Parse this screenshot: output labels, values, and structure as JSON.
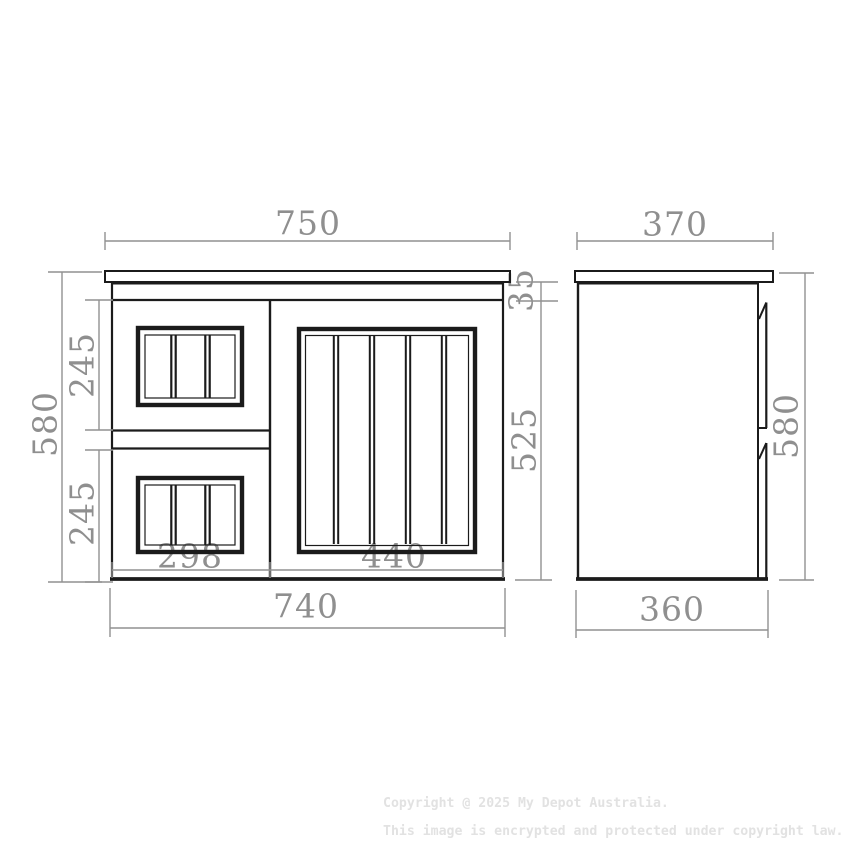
{
  "front_view": {
    "top_width": "750",
    "overall_height": "580",
    "upper_drawer_height": "245",
    "lower_drawer_height": "245",
    "top_rail_height": "35",
    "body_height": "525",
    "drawer_width": "298",
    "door_width": "440",
    "bottom_width": "740"
  },
  "side_view": {
    "top_depth": "370",
    "overall_height": "580",
    "bottom_depth": "360"
  },
  "footer": {
    "copyright_line1": "Copyright @ 2025 My Depot Australia.",
    "copyright_line2": "This image is encrypted and protected under copyright law."
  },
  "colors": {
    "drawing_line": "#1b1b1b",
    "dimension_line": "#919191",
    "dimension_text": "#8f8f8f",
    "watermark_text": "#e2e2e2",
    "background": "#ffffff"
  }
}
